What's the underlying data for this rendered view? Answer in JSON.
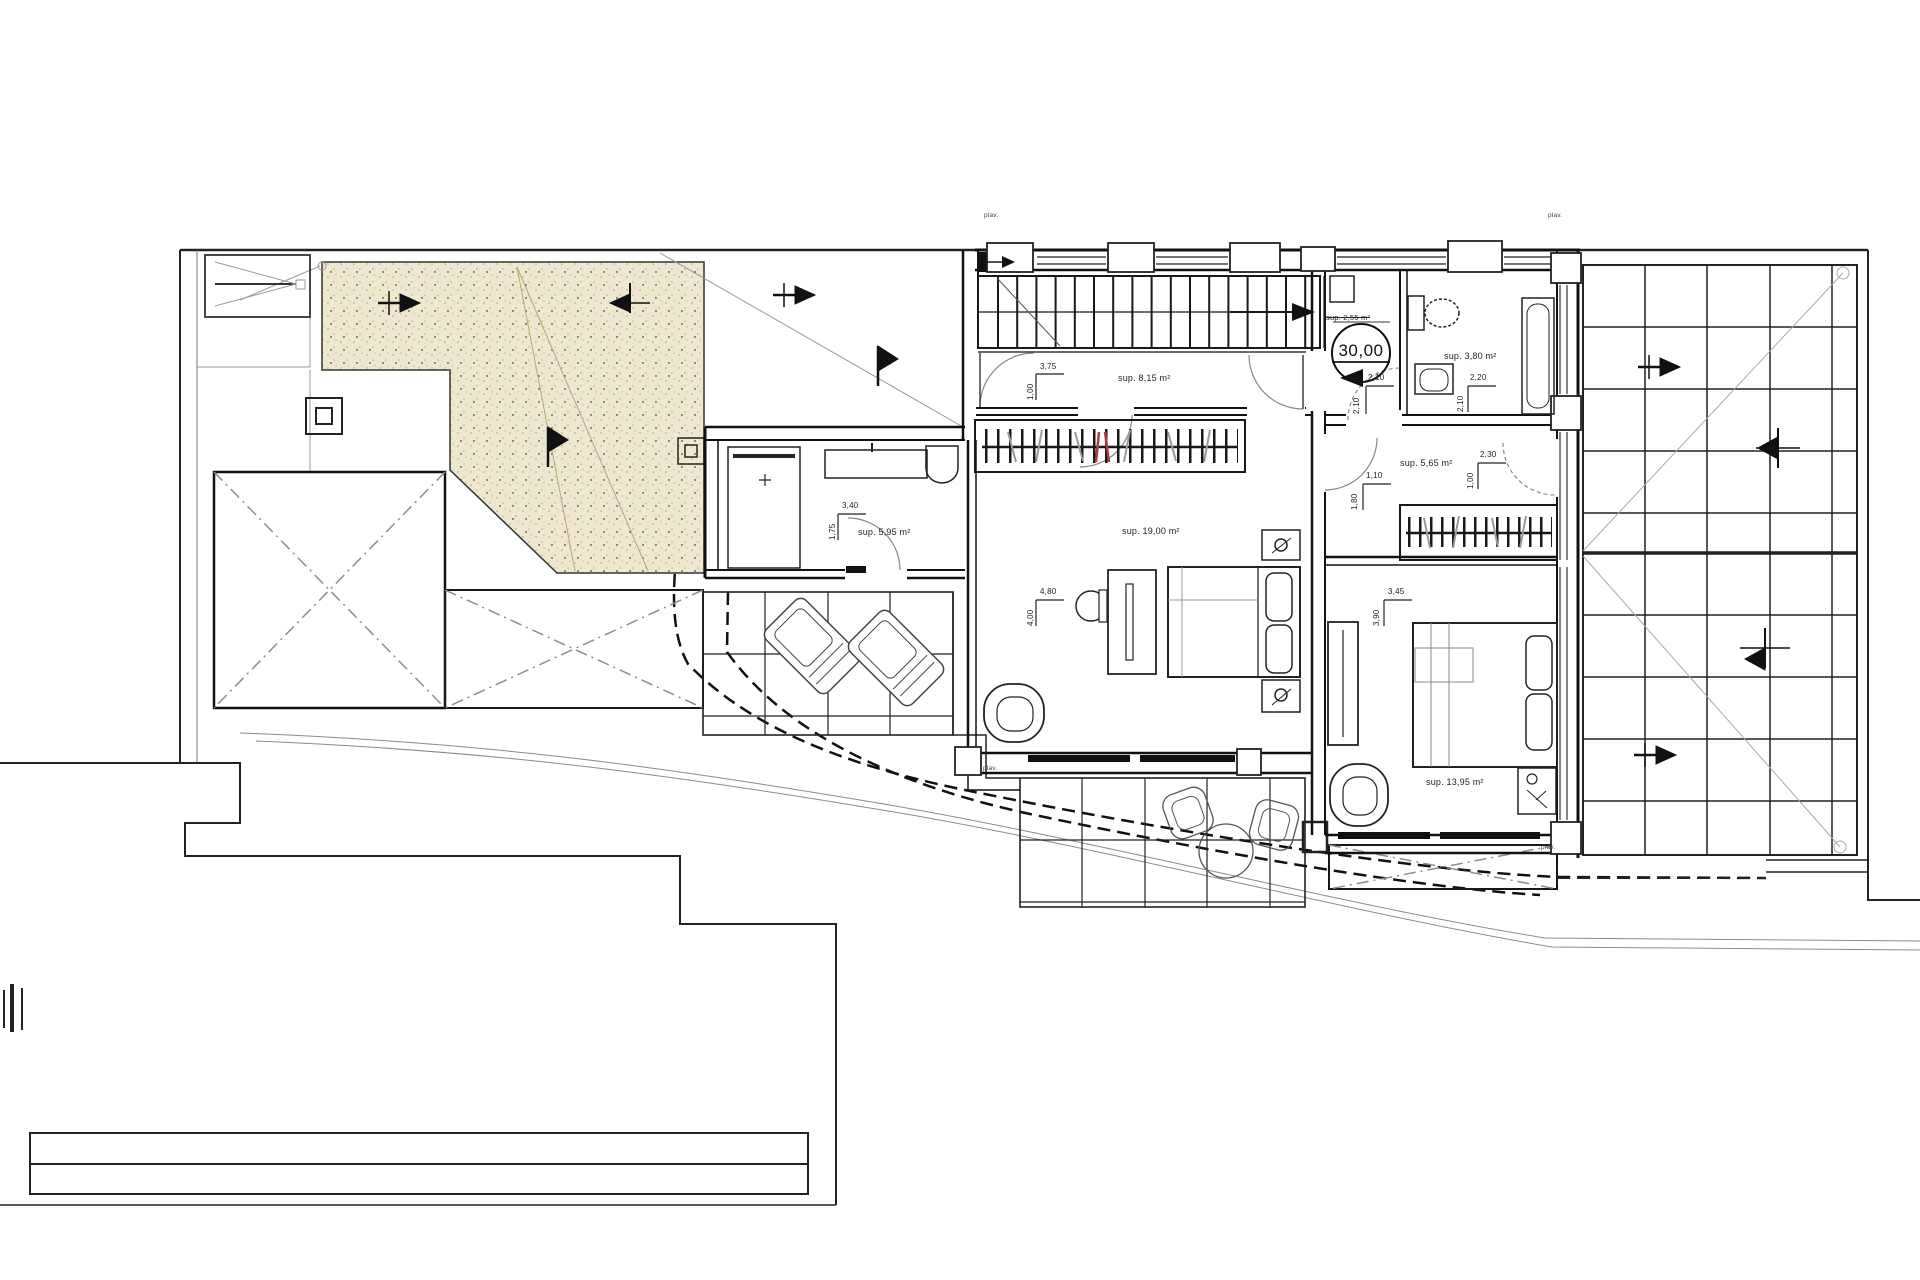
{
  "sheet": {
    "type": "architectural floor plan",
    "colors": {
      "line": "#1b1b1b",
      "sand_fill": "#efe8d0",
      "sand_speckle": "#c6b27c",
      "faint": "#999999",
      "red_item": "#b23a48"
    }
  },
  "level_marker": {
    "value": "30,00",
    "struck_area": "sup. 2,55 m²"
  },
  "areas": {
    "hall": "sup. 8,15 m²",
    "master": "sup. 19,00 m²",
    "bedroom_right": "sup. 13,95 m²",
    "bath_left": "sup. 5,95 m²",
    "dressing": "sup. 5,65 m²",
    "bath_top": "sup. 3,80 m²"
  },
  "dimensions": {
    "hall_w": "3,75",
    "hall_h": "1,00",
    "bath_left_w": "3,40",
    "bath_left_h": "1,75",
    "master_w": "4,80",
    "master_h": "4,00",
    "wc_w": "2,10",
    "wc_h": "2,10",
    "bath_top_w": "2,20",
    "bath_top_h": "2,10",
    "dressing_w": "2,30",
    "dressing_h": "1,00",
    "dressing_w2": "1,10",
    "dressing_h2": "1,80",
    "bedroom_right_w": "3,45",
    "bedroom_right_h": "3,90"
  },
  "window_label": "plav."
}
